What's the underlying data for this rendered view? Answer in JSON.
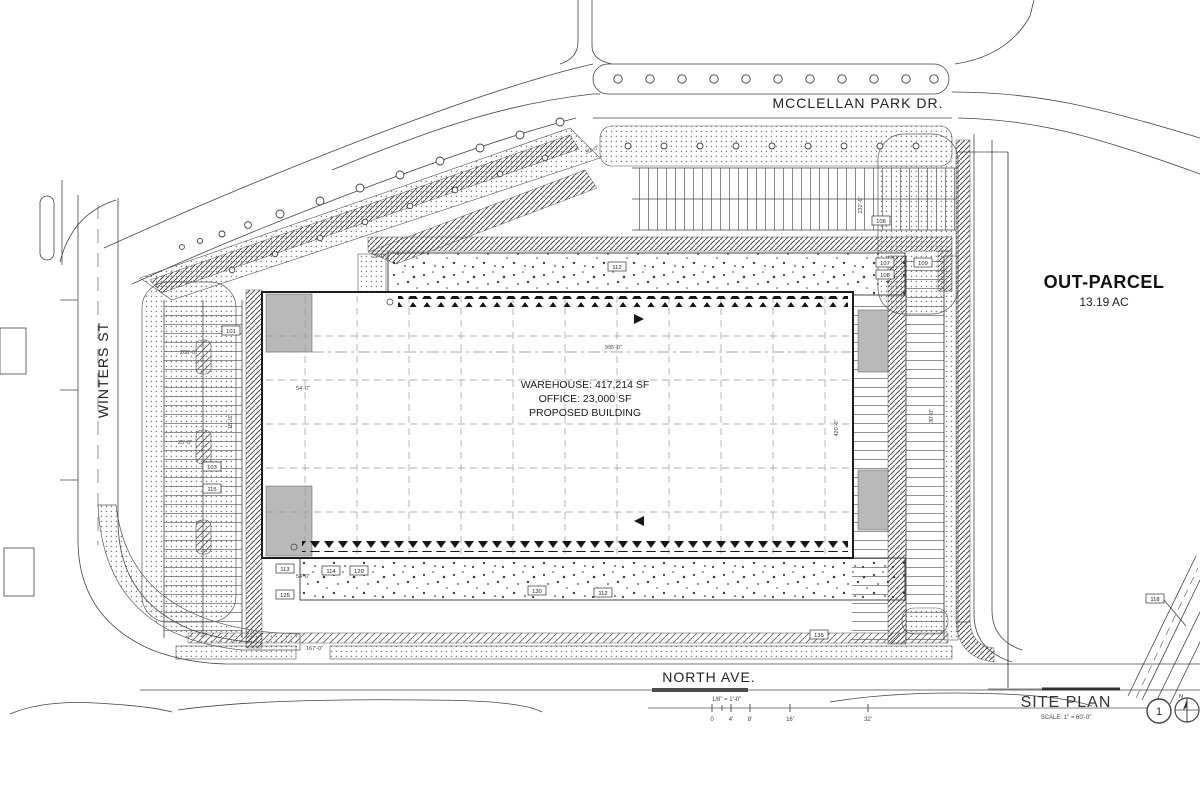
{
  "streets": {
    "top": "MCCLELLAN PARK DR.",
    "left": "WINTERS ST",
    "bottom": "NORTH AVE."
  },
  "building": {
    "line1": "WAREHOUSE: 417,214 SF",
    "line2": "OFFICE: 23,000 SF",
    "line3": "PROPOSED BUILDING"
  },
  "outparcel": {
    "name": "OUT-PARCEL",
    "area": "13.19 AC"
  },
  "title_block": {
    "drawing_title": "SITE PLAN",
    "scale_note": "SCALE: 1\" = 60'-0\"",
    "detail_number": "1",
    "north_label": "N"
  },
  "scale_bar": {
    "label": "1/8\" = 1'-0\"",
    "ticks": [
      "0",
      "4'",
      "8'",
      "16'",
      "32'"
    ]
  },
  "dimensions": {
    "building_length": "995'-0\"",
    "building_depth": "420'-0\"",
    "north_parking_depth": "232'-6\"",
    "west_bay": "208'-0\"",
    "dock_apron": "54'-0\"",
    "drive_aisle": "30'-0\"",
    "landscape_strip": "22'-0\"",
    "south_frontage": "167'-0\"",
    "stall_depth": "25'-0\"",
    "stall_width": "18'-0\""
  },
  "callouts": [
    {
      "label": "103"
    },
    {
      "label": "115"
    },
    {
      "label": "101"
    },
    {
      "label": "106"
    },
    {
      "label": "112"
    },
    {
      "label": "107"
    },
    {
      "label": "108"
    },
    {
      "label": "109"
    },
    {
      "label": "113"
    },
    {
      "label": "114"
    },
    {
      "label": "120"
    },
    {
      "label": "125"
    },
    {
      "label": "130"
    },
    {
      "label": "112"
    },
    {
      "label": "118"
    },
    {
      "label": "135"
    }
  ],
  "colors": {
    "line": "#2b2b2b",
    "hatch": "#555555",
    "paper": "#ffffff"
  }
}
